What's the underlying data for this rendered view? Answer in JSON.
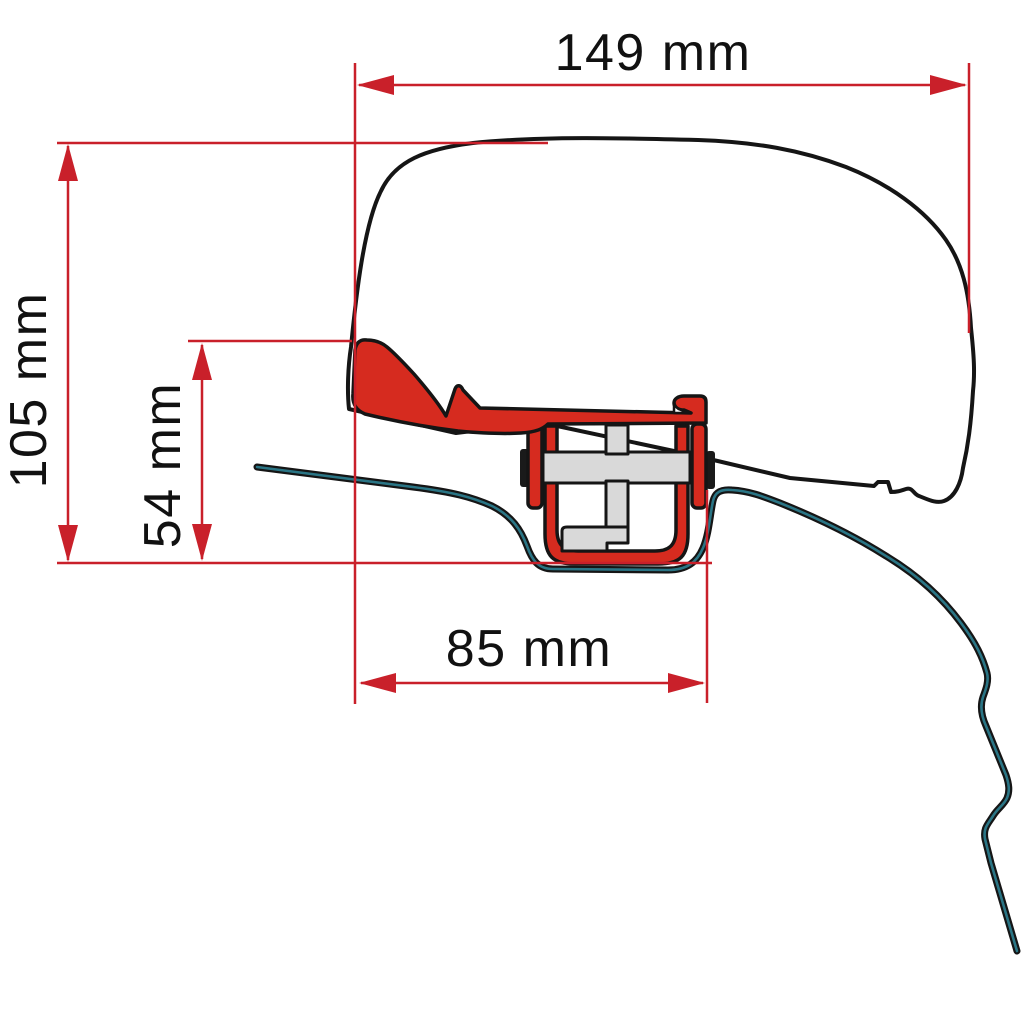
{
  "figure": {
    "type": "technical-dimension-drawing",
    "parts": [
      "awning-case-profile",
      "red-adapter-bracket",
      "t-bolt-assembly",
      "vehicle-roof-profile"
    ]
  },
  "dimensions": {
    "width_top": "149 mm",
    "height_total": "105 mm",
    "height_bracket": "54 mm",
    "width_bottom": "85 mm"
  },
  "colors": {
    "bracket-red": "#d62b1f",
    "dimension-red": "#c9202a",
    "roof-teal": "#2a7585",
    "outline-black": "#151515",
    "part-grey": "#d9d9d9",
    "label-black": "#111111",
    "background": "#ffffff"
  }
}
